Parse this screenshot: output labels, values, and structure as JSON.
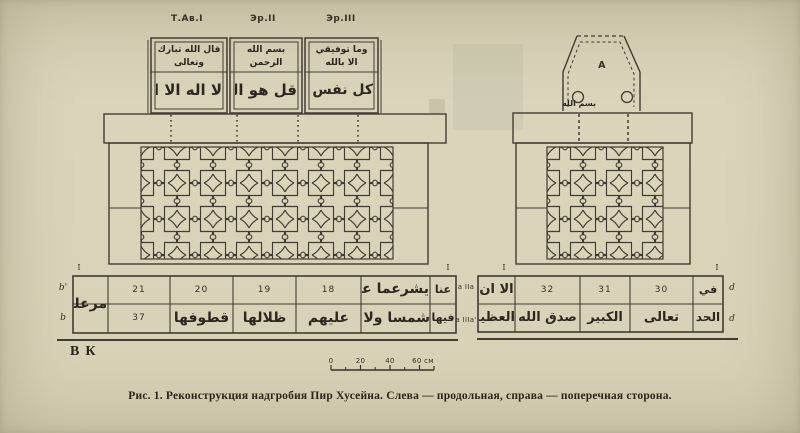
{
  "colors": {
    "paper": "#d9d3ba",
    "ink": "#372f25"
  },
  "figure": {
    "caption_label": "Рис. 1.",
    "caption_text": "Реконструкция надгробия Пир Хусейна. Слева — продольная, справа — поперечная сторона.",
    "authors_mark": "ВК"
  },
  "left_view": {
    "panel_labels": [
      "Т.Ав.I",
      "Эр.II",
      "Эр.III"
    ],
    "panels": [
      {
        "upper": "قال الله تبارك وتعالى",
        "lower": "لا اله الا الله"
      },
      {
        "upper": "بسم الله الرحمن الرحيم",
        "lower": "قل هو الله احد"
      },
      {
        "upper": "وما توفيقي الا بالله",
        "lower": "كل نفس ذائقة"
      }
    ],
    "corner_tick_left": "I",
    "corner_tick_right": "I",
    "row_label_top": "b'",
    "row_label_bottom": "b",
    "plinth": {
      "side_calligraphy": "مرعلى",
      "numbers_top": [
        "21",
        "20",
        "19",
        "18"
      ],
      "calligraphy_top": [
        "يشرعما عاد",
        "عنا"
      ],
      "number_bottom": "37",
      "calligraphy_bottom": [
        "قطوفها",
        "ظلالها",
        "عليهم",
        "شمسا ولا ز",
        "فيها"
      ]
    }
  },
  "middle_labels": {
    "top": "a IIa",
    "bottom": "a IIIa'"
  },
  "right_view": {
    "apex_label": "A",
    "apex_scribble": "بسم الله",
    "corner_tick_left": "I",
    "corner_tick_right": "I",
    "row_label_top": "d",
    "row_label_bottom": "d",
    "plinth": {
      "calligraphy_top_first": "الا ان",
      "numbers_top": [
        "32",
        "31",
        "30"
      ],
      "calligraphy_top_last": "في",
      "calligraphy_bottom": [
        "العظيم",
        "صدق الله",
        "الكبير",
        "تعالى",
        "الحد"
      ]
    }
  },
  "scale_bar": {
    "tick_labels": [
      "0",
      "20",
      "40"
    ],
    "end_label": "60 см"
  }
}
